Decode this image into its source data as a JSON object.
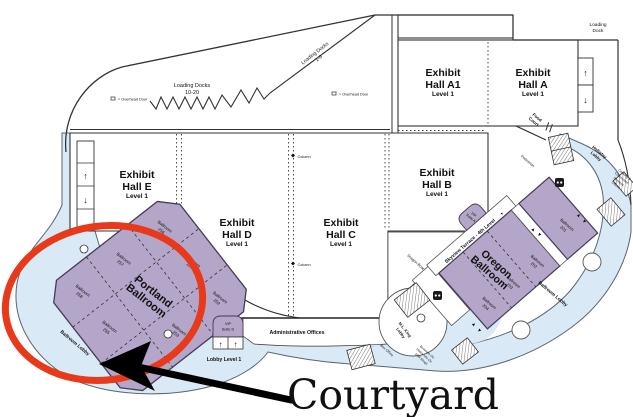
{
  "map": {
    "icons": {
      "elevator_up": "↑",
      "elevator_down": "↓",
      "tri_up": "▲",
      "tri_down": "▼"
    },
    "halls": [
      {
        "l1": "Exhibit",
        "l2": "Hall A1",
        "l3": "Level 1"
      },
      {
        "l1": "Exhibit",
        "l2": "Hall A",
        "l3": "Level 1"
      },
      {
        "l1": "Exhibit",
        "l2": "Hall B",
        "l3": "Level 1"
      },
      {
        "l1": "Exhibit",
        "l2": "Hall C",
        "l3": "Level 1"
      },
      {
        "l1": "Exhibit",
        "l2": "Hall D",
        "l3": "Level 1"
      },
      {
        "l1": "Exhibit",
        "l2": "Hall E",
        "l3": "Level 1"
      }
    ],
    "portland": {
      "t1": "Portland",
      "t2": "Ballroom",
      "cells": [
        {
          "w": "Ballroom",
          "n": "258"
        },
        {
          "w": "Ballroom",
          "n": "257"
        },
        {
          "w": "Ballroom",
          "n": "256"
        },
        {
          "w": "Ballroom",
          "n": "255"
        },
        {
          "w": "Ballroom",
          "n": "251"
        },
        {
          "w": "Ballroom",
          "n": "254"
        },
        {
          "w": "Ballroom",
          "n": "253"
        },
        {
          "w": "Ballroom",
          "n": "252"
        }
      ]
    },
    "oregon": {
      "t1": "Oregon",
      "t2": "Ballroom",
      "cells": [
        {
          "w": "Ballroom",
          "n": "204"
        },
        {
          "w": "Ballroom",
          "n": "203"
        },
        {
          "w": "Ballroom",
          "n": "202"
        },
        {
          "w": "Ballroom",
          "n": "201"
        }
      ]
    },
    "vip_a": {
      "l1": "VIP",
      "l2": "Suite A"
    },
    "vip_d": {
      "l1": "VIP",
      "l2": "Suite D"
    },
    "labels": {
      "ld1020_l1": "Loading Docks",
      "ld1020_l2": "10-20",
      "ld19_l1": "Loading Docks",
      "ld19_l2": "1-9",
      "ldock_l1": "Loading",
      "ldock_l2": "Dock",
      "overhead": "= Overhead Door",
      "column": "Column",
      "food_l1": "Food",
      "food_l2": "Court",
      "pedestrian": "Pedestrian",
      "holladay_l1": "Holladay",
      "holladay_l2": "Lobby",
      "cater_l1": "Catering &",
      "cater_l2": "Concession",
      "cater_l3": "Services",
      "cater_l4": "Offices",
      "skyview": "Skyview Terrace - 4th Level",
      "dragon": "Dragon Boat",
      "ballroom_lobby": "Ballroom Lobby",
      "mlk_l1": "M.L. King",
      "mlk_l2": "Lobby",
      "box_office": "Box Office",
      "biz_l1": "Business Ctr.",
      "biz_l2": "Visitor Info Ctr.",
      "biz_l3": "(Gift Shop)",
      "admin": "Administrative Offices",
      "lobby_level": "Lobby Level 1"
    },
    "annotation": {
      "courtyard": "Courtyard"
    },
    "colors": {
      "ballroom_fill": "#b3a6c8",
      "lobby_fill": "#d9e9f6",
      "highlight": "#e8391b"
    }
  }
}
